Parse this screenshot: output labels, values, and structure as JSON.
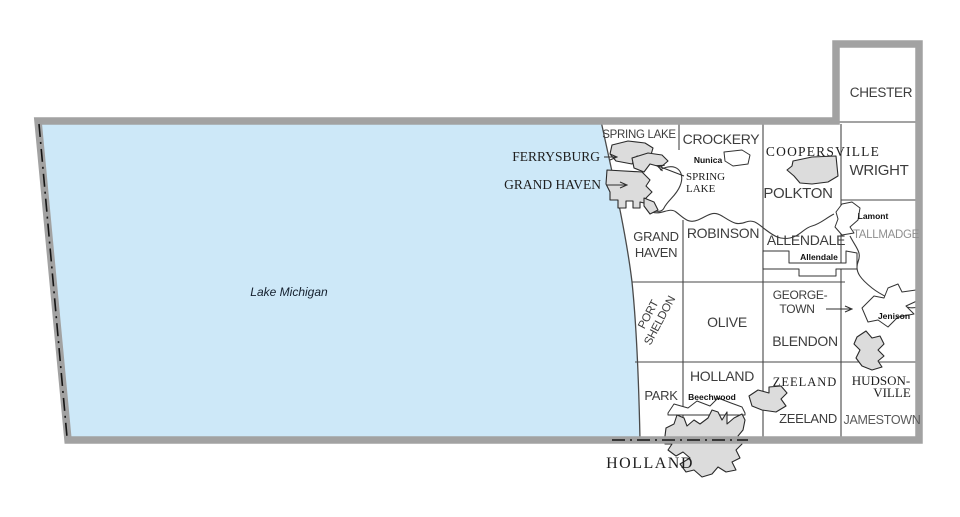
{
  "map_title": "Ottawa County township and municipality map",
  "lake": {
    "label": "Lake Michigan"
  },
  "townships": {
    "chester": "CHESTER",
    "spring_lake": "SPRING LAKE",
    "crockery": "CROCKERY",
    "wright": "WRIGHT",
    "polkton": "POLKTON",
    "tallmadge": "TALLMADGE",
    "grand_haven_line1": "GRAND",
    "grand_haven_line2": "HAVEN",
    "robinson": "ROBINSON",
    "allendale": "ALLENDALE",
    "port_sheldon_line1": "PORT",
    "port_sheldon_line2": "SHELDON",
    "olive": "OLIVE",
    "georgetown_line1": "GEORGE-",
    "georgetown_line2": "TOWN",
    "blendon": "BLENDON",
    "park": "PARK",
    "holland": "HOLLAND",
    "zeeland": "ZEELAND",
    "jamestown": "JAMESTOWN"
  },
  "cities": {
    "ferrysburg": "FERRYSBURG",
    "grand_haven": "GRAND HAVEN",
    "spring_lake_line1": "SPRING",
    "spring_lake_line2": "LAKE",
    "coopersville": "COOPERSVILLE",
    "hudsonville_line1": "HUDSON-",
    "hudsonville_line2": "VILLE",
    "zeeland": "ZEELAND",
    "holland": "HOLLAND"
  },
  "communities": {
    "nunica": "Nunica",
    "lamont": "Lamont",
    "allendale": "Allendale",
    "jenison": "Jenison",
    "beechwood": "Beechwood"
  },
  "colors": {
    "lake": "#cde8f8",
    "county_border": "#a2a2a2",
    "city_fill": "#dcdcdc",
    "cdp_fill": "#ffffff",
    "boundary_line": "#474747",
    "state_line": "#141414",
    "township_label": "#3d3d3d",
    "tallmadge_label": "#8f8f8f",
    "serif_label": "#1e1e1e",
    "background": "#ffffff"
  }
}
